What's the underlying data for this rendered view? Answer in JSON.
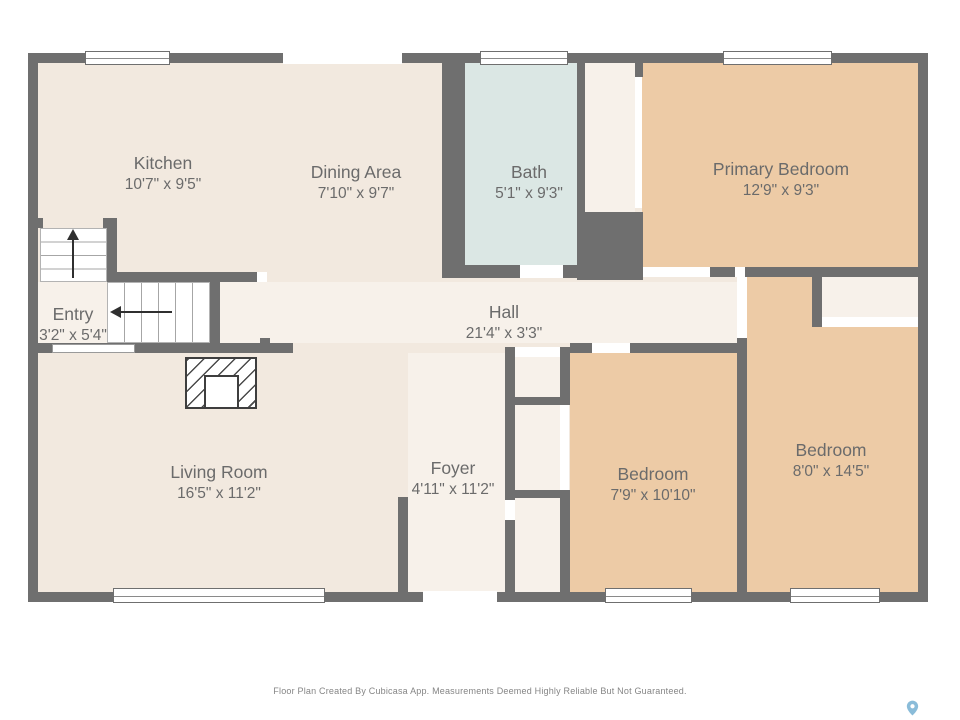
{
  "plan": {
    "rooms": [
      {
        "id": "kitchen",
        "name": "Kitchen",
        "dims": "10'7\" x 9'5\""
      },
      {
        "id": "dining-area",
        "name": "Dining Area",
        "dims": "7'10\" x 9'7\""
      },
      {
        "id": "bath",
        "name": "Bath",
        "dims": "5'1\" x 9'3\""
      },
      {
        "id": "primary-bedroom",
        "name": "Primary Bedroom",
        "dims": "12'9\" x 9'3\""
      },
      {
        "id": "entry",
        "name": "Entry",
        "dims": "3'2\" x 5'4\""
      },
      {
        "id": "hall",
        "name": "Hall",
        "dims": "21'4\" x 3'3\""
      },
      {
        "id": "living-room",
        "name": "Living Room",
        "dims": "16'5\" x 11'2\""
      },
      {
        "id": "foyer",
        "name": "Foyer",
        "dims": "4'11\" x 11'2\""
      },
      {
        "id": "bedroom-small",
        "name": "Bedroom",
        "dims": "7'9\" x 10'10\""
      },
      {
        "id": "bedroom-large",
        "name": "Bedroom",
        "dims": "8'0\" x 14'5\""
      }
    ]
  },
  "footer": {
    "disclaimer": "Floor Plan Created By Cubicasa App. Measurements Deemed Highly Reliable But Not Guaranteed."
  },
  "colors": {
    "wall": "#6f6f6f",
    "floor_main": "#f2e9df",
    "floor_light": "#f7f1ea",
    "floor_bath": "#dbe7e4",
    "floor_bedroom": "#edcba6",
    "label_text": "#6b6b6b",
    "logo_pin": "#8abcd9"
  }
}
